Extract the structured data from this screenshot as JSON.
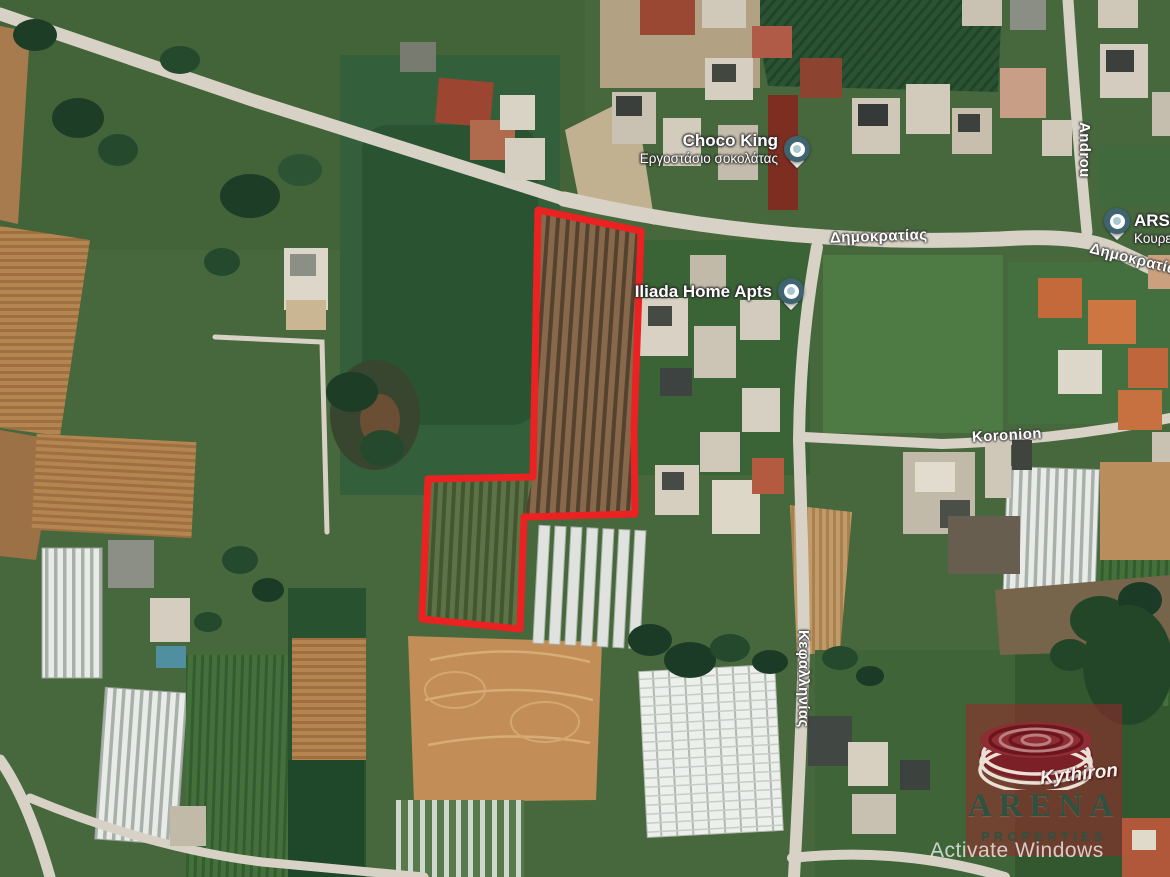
{
  "map": {
    "pois": [
      {
        "title": "Choco King",
        "subtitle": "Εργοστάσιο σοκολάτας"
      },
      {
        "title": "Iliada Home Apts",
        "subtitle": ""
      },
      {
        "title": "ARSM",
        "subtitle": "Κουρεία"
      }
    ],
    "road_labels": [
      {
        "name": "Δημοκρατίας"
      },
      {
        "name": "Δημοκρατίας"
      },
      {
        "name": "Androu"
      },
      {
        "name": "Koronion"
      },
      {
        "name": "Κεφαλληνίας"
      }
    ],
    "colors": {
      "plot_outline": "#ec2222",
      "poi_pin": "#3f6470",
      "road_fill": "#d8d2c6"
    }
  },
  "branding": {
    "agency_name": "ARENA",
    "agency_tagline": "PROPERTIES",
    "agency_brand": "Kythiron"
  },
  "os_watermark": {
    "text": "Activate Windows"
  }
}
